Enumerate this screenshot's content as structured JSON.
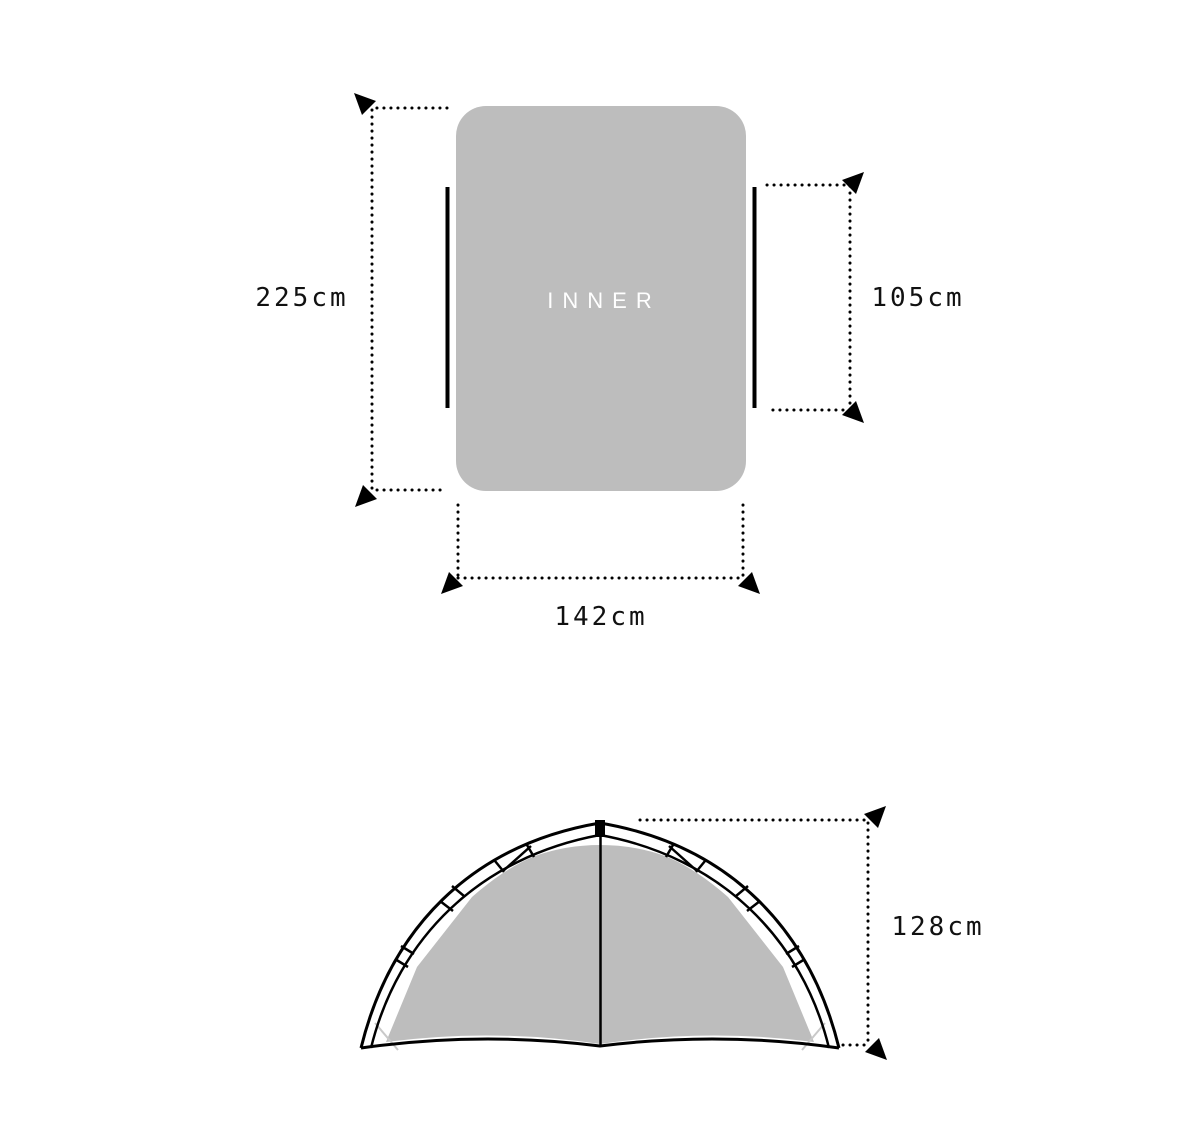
{
  "colors": {
    "fill_gray": "#bdbdbd",
    "line_black": "#000000",
    "label_dark": "#111111",
    "label_white": "#ffffff",
    "guy_line_gray": "#c9c9c9"
  },
  "top_view": {
    "inner_label": "INNER",
    "length_label": "225cm",
    "door_height_label": "105cm",
    "width_label": "142cm"
  },
  "front_view": {
    "height_label": "128cm"
  }
}
